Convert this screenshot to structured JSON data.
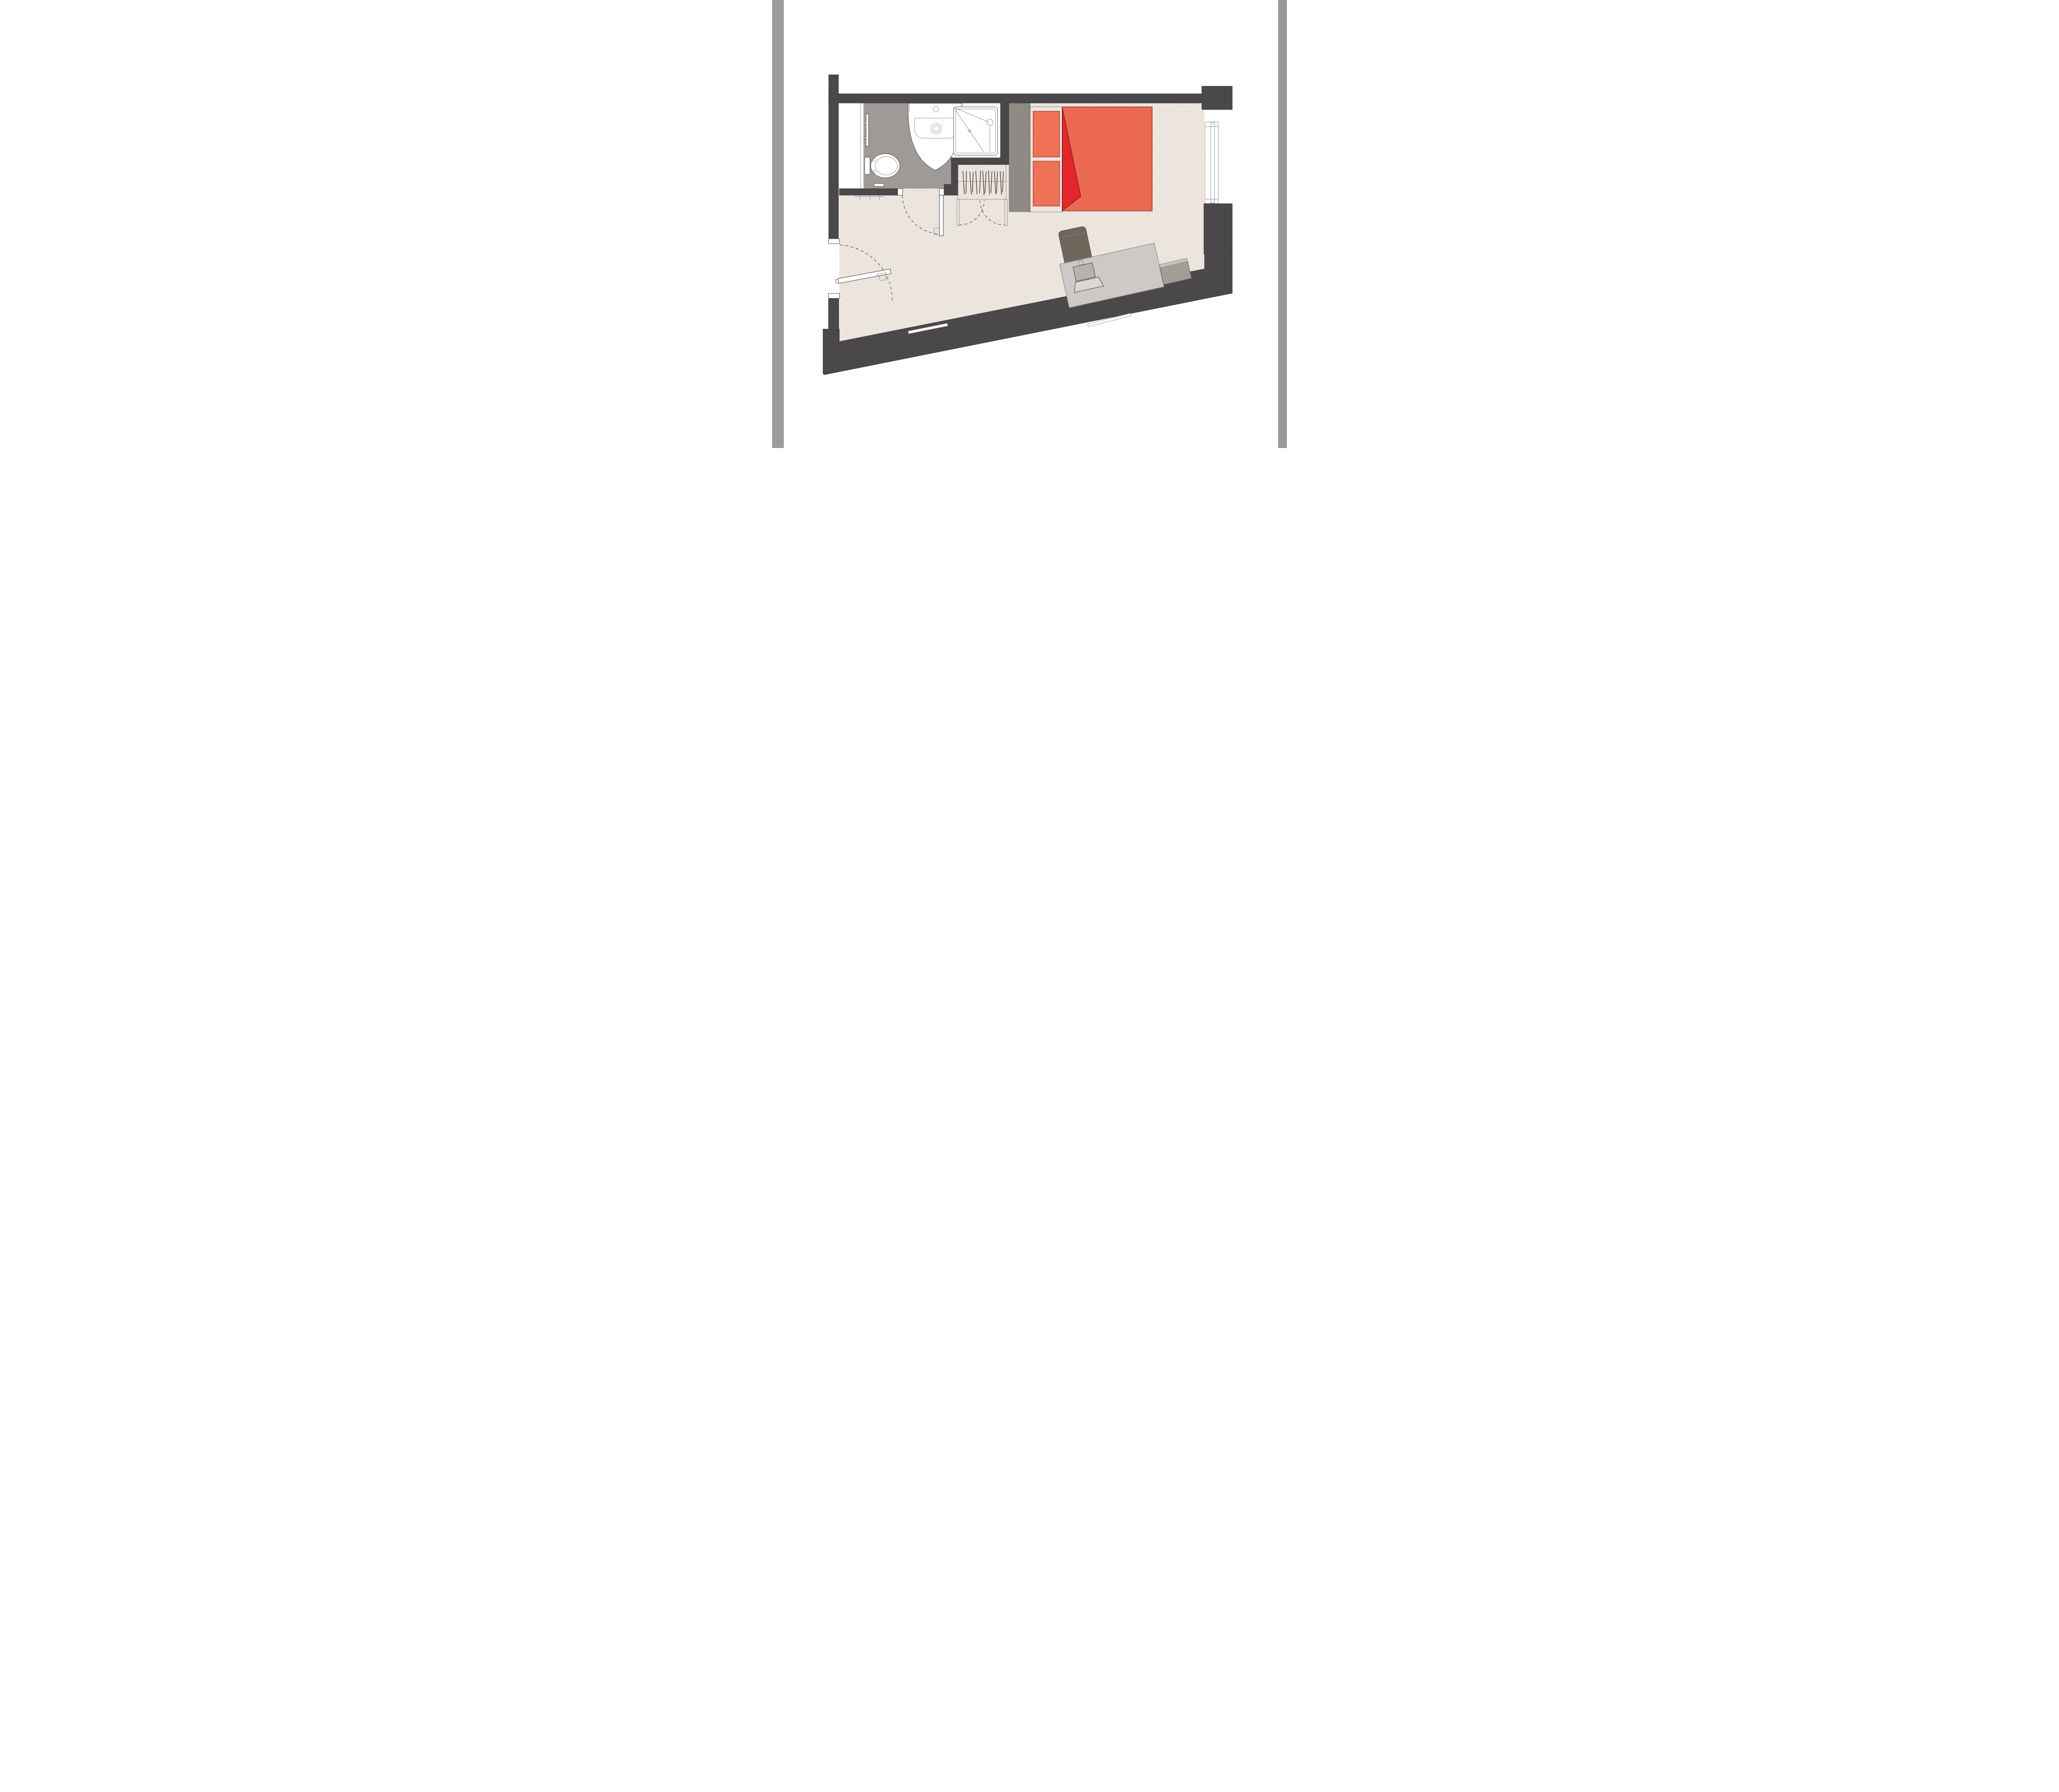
{
  "page": {
    "type": "architectural-floor-plan",
    "background": "#ffffff"
  },
  "borders": {
    "left_color": "#9b9c9e",
    "right_color": "#97989a"
  },
  "palette": {
    "wall": "#4a4848",
    "floor": "#ede6df",
    "floor_speckle": "#d9cbbf",
    "bath_floor": "#9d9a97",
    "white": "#ffffff",
    "wardrobe": "#b2afac",
    "wardrobe_panel": "#ffffff",
    "headboard": "#8f8a85",
    "bed_frame": "#ffffff",
    "pillow": "#ef7156",
    "duvet": "#ec6951",
    "fold_red": "#e3262b",
    "desk": "#cdc9c6",
    "chair": "#6f675c",
    "cabinet": "#a39d97",
    "cabinet_edge": "#c9c5c2",
    "laptop_screen": "#b7b2ae",
    "keyboard": "#dad7d4",
    "door_leaf": "#ffffff"
  },
  "plan": {
    "rooms": [
      "studio-room",
      "bathroom"
    ],
    "fixtures": [
      "sink",
      "toilet",
      "toilet-paper-holder",
      "towel-rail",
      "shower",
      "wardrobe",
      "bed",
      "pillows",
      "duvet",
      "folded-blanket",
      "desk",
      "desk-chair",
      "laptop",
      "bedside-cabinet",
      "entry-door",
      "bathroom-door",
      "window",
      "coat-rack"
    ]
  }
}
